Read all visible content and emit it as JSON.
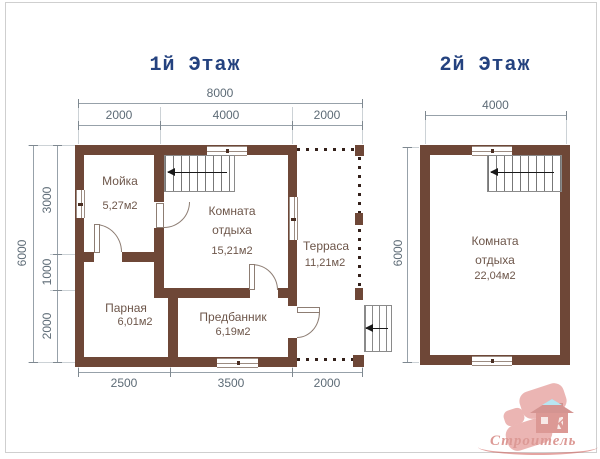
{
  "floor1": {
    "title": "1й Этаж",
    "dims": {
      "top_total": "8000",
      "top_segments": [
        "2000",
        "4000",
        "2000"
      ],
      "left_total": "6000",
      "left_segments": [
        "3000",
        "1000",
        "2000"
      ],
      "bottom_segments": [
        "2500",
        "3500",
        "2000"
      ]
    },
    "rooms": [
      {
        "name": "Мойка",
        "area": "5,27м2"
      },
      {
        "name": "Комната отдыха",
        "area": "15,21м2"
      },
      {
        "name": "Терраса",
        "area": "11,21м2"
      },
      {
        "name": "Парная",
        "area": "6,01м2"
      },
      {
        "name": "Предбанник",
        "area": "6,19м2"
      }
    ]
  },
  "floor2": {
    "title": "2й Этаж",
    "dims": {
      "top_total": "4000",
      "left_total": "6000"
    },
    "rooms": [
      {
        "name": "Комната отдыха",
        "area": "22,04м2"
      }
    ]
  },
  "logo": {
    "brand": "Строитель",
    "letter": "К"
  },
  "colors": {
    "wall": "#6e4737",
    "title": "#24427f",
    "dim_text": "#5d6b76",
    "dim_line": "#97a1a9",
    "ext_line": "#ccd2d6",
    "room_text": "#6d564a",
    "logo_red": "#c0473f"
  }
}
